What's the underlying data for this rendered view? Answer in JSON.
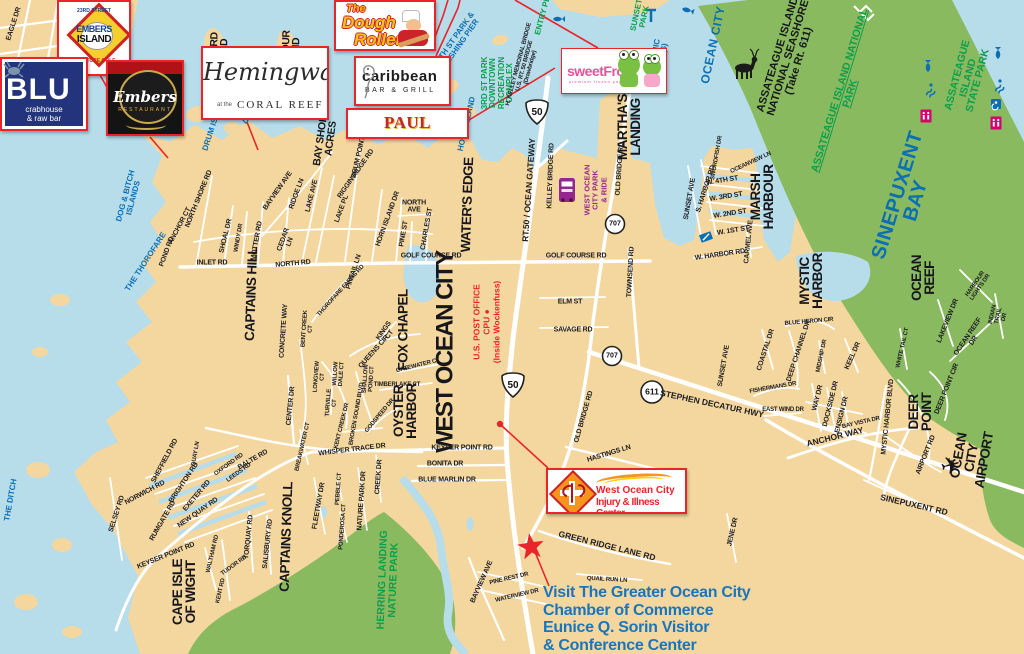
{
  "colors": {
    "water": "#b7dcea",
    "land": "#f4d79f",
    "green": "#8aba60",
    "label_blue": "#0b6fb4",
    "park_green": "#0d9e4c",
    "red": "#e8252a",
    "purple": "#93278f",
    "chamber_blue": "#1b75bc"
  },
  "ads": {
    "embers_island": {
      "l1": "23RD STREET",
      "l2": "EMBERS",
      "l3": "ISLAND",
      "l4": "MINIATURE GOLF"
    },
    "blu": {
      "name": "BLU",
      "sub1": "crabhouse",
      "sub2": "& raw bar"
    },
    "embers": {
      "name": "Embers",
      "sub": "RESTAURANT"
    },
    "hemingways": {
      "script": "Hemingway's",
      "at": "at the",
      "sub": "CORAL REEF"
    },
    "dough_roller": {
      "l1": "The",
      "l2": "Dough",
      "l3": "Roller"
    },
    "caribbean": {
      "name": "caribbean",
      "sub": "BAR & GRILL"
    },
    "paul_revere": {
      "name": "PAUL REVERE"
    },
    "sweetfrog": {
      "name": "sweetFrog",
      "sub": "premium frozen yogurt"
    },
    "injury_center": {
      "l1": "West Ocean City",
      "l2": "Injury & Illness Center"
    }
  },
  "chamber": {
    "l1": "Visit The Greater Ocean City",
    "l2": "Chamber of Commerce",
    "l3": "Eunice Q. Sorin Visitor",
    "l4": "& Conference Center"
  },
  "map_labels": [
    {
      "t": "DOG & BITCH\nISLANDS",
      "x": 130,
      "y": 197,
      "r": -75,
      "c": "water"
    },
    {
      "t": "THE THOROFARE",
      "x": 146,
      "y": 262,
      "r": -57,
      "c": "water"
    },
    {
      "t": "THE DITCH",
      "x": 11,
      "y": 500,
      "r": -80,
      "c": "water"
    },
    {
      "t": "DRUM ISLAND",
      "x": 214,
      "y": 124,
      "r": -72,
      "c": "water"
    },
    {
      "t": "DRUM POINT",
      "x": 263,
      "y": 106,
      "r": -42,
      "c": "water"
    },
    {
      "t": "HORN ISLAND",
      "x": 467,
      "y": 124,
      "r": -77,
      "c": "water"
    },
    {
      "t": "4TH ST PARK &\nFISHING PIER",
      "x": 459,
      "y": 40,
      "r": -55,
      "c": "water"
    },
    {
      "t": "OCEANIC\nPIER ($)",
      "x": 659,
      "y": 58,
      "r": -80,
      "c": "water"
    },
    {
      "t": "OCEAN CITY",
      "x": 713,
      "y": 45,
      "r": -78,
      "c": "water-lg"
    },
    {
      "t": "SINEPUXENT\nBAY",
      "x": 907,
      "y": 198,
      "r": -73,
      "c": "water-xl"
    },
    {
      "t": "3RD ST PARK\nDOWNTOWN\nRECREATION\nCOMPLEX",
      "x": 498,
      "y": 83,
      "r": -90,
      "c": "park"
    },
    {
      "t": "ENTRY PL",
      "x": 543,
      "y": 16,
      "r": -75,
      "c": "park"
    },
    {
      "t": "SUNSET\nPARK",
      "x": 641,
      "y": 16,
      "r": -78,
      "c": "park"
    },
    {
      "t": "ASSATEAGUE ISLAND NATIONAL PARK",
      "x": 845,
      "y": 92,
      "r": -73,
      "c": "park-lg u"
    },
    {
      "t": "ASSATEAGUE ISLAND\nSTATE PARK",
      "x": 968,
      "y": 78,
      "r": -75,
      "c": "park-lg"
    },
    {
      "t": "HERRING LANDING\nNATURE PARK",
      "x": 388,
      "y": 580,
      "r": -88,
      "c": "park-lg"
    },
    {
      "t": "ASSATEAGUE ISLAND\nNATIONAL SEASHORE\n(Take Rt. 611)",
      "x": 789,
      "y": 58,
      "r": -73,
      "c": "seashore"
    },
    {
      "t": "WEST OCEAN\nCITY PARK\n& RIDE",
      "x": 596,
      "y": 190,
      "r": -90,
      "c": "purple"
    },
    {
      "t": "U.S. POST OFFICE\nCPU ●\n(Inside Wockenfuss)",
      "x": 487,
      "y": 322,
      "r": -90,
      "c": "redlbl"
    },
    {
      "t": "MALLARD\nISLAND",
      "x": 219,
      "y": 57,
      "r": -88,
      "c": "area"
    },
    {
      "t": "HARBOUR\nISLAND",
      "x": 291,
      "y": 56,
      "r": -88,
      "c": "area"
    },
    {
      "t": "BAY SHORE\nACRES",
      "x": 326,
      "y": 138,
      "r": -82,
      "c": "area"
    },
    {
      "t": "WATER'S EDGE",
      "x": 468,
      "y": 205,
      "r": -88,
      "c": "area-lg"
    },
    {
      "t": "MARTHA'S\nLANDING",
      "x": 630,
      "y": 127,
      "r": -90,
      "c": "area-lg"
    },
    {
      "t": "MARSH\nHARBOUR",
      "x": 763,
      "y": 197,
      "r": -90,
      "c": "area-lg"
    },
    {
      "t": "MYSTIC\nHARBOR",
      "x": 812,
      "y": 281,
      "r": -90,
      "c": "area-lg"
    },
    {
      "t": "OCEAN\nREEF",
      "x": 924,
      "y": 278,
      "r": -90,
      "c": "area-lg"
    },
    {
      "t": "DEER\nPOINT",
      "x": 921,
      "y": 412,
      "r": -90,
      "c": "area-lg"
    },
    {
      "t": "CAPE ISLE\nOF WIGHT",
      "x": 185,
      "y": 592,
      "r": -90,
      "c": "area-lg"
    },
    {
      "t": "CAPTAINS KNOLL",
      "x": 287,
      "y": 537,
      "r": -88,
      "c": "area-lg"
    },
    {
      "t": "CAPTAINS HILL",
      "x": 252,
      "y": 294,
      "r": -88,
      "c": "area-lg"
    },
    {
      "t": "WEST OCEAN CITY",
      "x": 446,
      "y": 352,
      "r": -90,
      "c": "area-xl"
    },
    {
      "t": "FOX CHAPEL",
      "x": 404,
      "y": 330,
      "r": -90,
      "c": "area-lg"
    },
    {
      "t": "OYSTER\nHARBOR",
      "x": 406,
      "y": 411,
      "r": -90,
      "c": "area-lg"
    },
    {
      "t": "OCEAN CITY AIRPORT",
      "x": 972,
      "y": 458,
      "r": -80,
      "c": "area-lg"
    },
    {
      "t": "✈",
      "x": 951,
      "y": 467,
      "r": -15,
      "c": "plane"
    },
    {
      "t": "EAGLE DR",
      "x": 14,
      "y": 24,
      "r": -72,
      "c": "road"
    },
    {
      "t": "DRUM POINT RD",
      "x": 360,
      "y": 152,
      "r": -77,
      "c": "road"
    },
    {
      "t": "NORTH SHORE RD",
      "x": 199,
      "y": 199,
      "r": -68,
      "c": "road"
    },
    {
      "t": "ANCHOR CT",
      "x": 180,
      "y": 226,
      "r": -62,
      "c": "road"
    },
    {
      "t": "POND RD",
      "x": 167,
      "y": 252,
      "r": -70,
      "c": "road"
    },
    {
      "t": "SHOAL DR",
      "x": 226,
      "y": 236,
      "r": -76,
      "c": "road"
    },
    {
      "t": "WINDY DR",
      "x": 239,
      "y": 238,
      "r": -80,
      "c": "road-sm"
    },
    {
      "t": "MOTTER RD",
      "x": 257,
      "y": 241,
      "r": -80,
      "c": "road"
    },
    {
      "t": "CEDAR\nLN",
      "x": 287,
      "y": 241,
      "r": -70,
      "c": "road"
    },
    {
      "t": "INLET RD",
      "x": 212,
      "y": 263,
      "r": 0,
      "c": "road"
    },
    {
      "t": "NORTH RD",
      "x": 293,
      "y": 264,
      "r": -5,
      "c": "road"
    },
    {
      "t": "BAYVIEW AVE",
      "x": 278,
      "y": 191,
      "r": -55,
      "c": "road"
    },
    {
      "t": "RIDGE LN",
      "x": 297,
      "y": 194,
      "r": -70,
      "c": "road"
    },
    {
      "t": "LAKE AVE",
      "x": 312,
      "y": 196,
      "r": -76,
      "c": "road"
    },
    {
      "t": "LAKE PL",
      "x": 342,
      "y": 209,
      "r": -70,
      "c": "road"
    },
    {
      "t": "RIGGIN RIDGE RD",
      "x": 356,
      "y": 174,
      "r": -55,
      "c": "road"
    },
    {
      "t": "HORN ISLAND DR",
      "x": 388,
      "y": 219,
      "r": -70,
      "c": "road"
    },
    {
      "t": "PINE ST",
      "x": 404,
      "y": 234,
      "r": -80,
      "c": "road"
    },
    {
      "t": "NORTH\nAVE",
      "x": 414,
      "y": 207,
      "r": 0,
      "c": "road"
    },
    {
      "t": "CHARLES ST",
      "x": 427,
      "y": 229,
      "r": -80,
      "c": "road"
    },
    {
      "t": "GOLF COURSE RD",
      "x": 431,
      "y": 256,
      "r": 0,
      "c": "road"
    },
    {
      "t": "GOLF COURSE RD",
      "x": 576,
      "y": 256,
      "r": 0,
      "c": "road"
    },
    {
      "t": "PINTAIL LN",
      "x": 354,
      "y": 272,
      "r": -72,
      "c": "road"
    },
    {
      "t": "THOROFARE FARMS RD",
      "x": 341,
      "y": 291,
      "r": -48,
      "c": "road-sm"
    },
    {
      "t": "CONCRETE WAY",
      "x": 284,
      "y": 331,
      "r": -86,
      "c": "road"
    },
    {
      "t": "BENT CREEK\nCT",
      "x": 308,
      "y": 329,
      "r": -86,
      "c": "road-sm"
    },
    {
      "t": "KINGS\nCT",
      "x": 387,
      "y": 333,
      "r": -55,
      "c": "road"
    },
    {
      "t": "QUEENS CIR",
      "x": 374,
      "y": 352,
      "r": -48,
      "c": "road"
    },
    {
      "t": "GATEWATER CT",
      "x": 418,
      "y": 366,
      "r": -14,
      "c": "road-sm"
    },
    {
      "t": "TIMBERLAKE CT",
      "x": 397,
      "y": 385,
      "r": 0,
      "c": "road-sm"
    },
    {
      "t": "LONGVIEW\nCT",
      "x": 320,
      "y": 377,
      "r": -86,
      "c": "road-sm"
    },
    {
      "t": "WILLOW\nDALE CT",
      "x": 339,
      "y": 374,
      "r": -86,
      "c": "road-sm"
    },
    {
      "t": "SHALLOW\nPOND CT",
      "x": 369,
      "y": 379,
      "r": -86,
      "c": "road-sm"
    },
    {
      "t": "TURVILLE\nCT",
      "x": 332,
      "y": 403,
      "r": -86,
      "c": "road-sm"
    },
    {
      "t": "BROKEN SOUND BLVD",
      "x": 357,
      "y": 414,
      "r": -80,
      "c": "road-sm"
    },
    {
      "t": "GODSPEED DR",
      "x": 380,
      "y": 416,
      "r": -50,
      "c": "road-sm"
    },
    {
      "t": "KENT CREEK DR",
      "x": 342,
      "y": 426,
      "r": -76,
      "c": "road-sm"
    },
    {
      "t": "CENTER DR",
      "x": 291,
      "y": 406,
      "r": -84,
      "c": "road"
    },
    {
      "t": "ELM ST",
      "x": 570,
      "y": 302,
      "r": 0,
      "c": "road"
    },
    {
      "t": "SAVAGE RD",
      "x": 573,
      "y": 330,
      "r": 0,
      "c": "road"
    },
    {
      "t": "RT.50 / OCEAN GATEWAY",
      "x": 529,
      "y": 190,
      "r": -86,
      "c": "road-lg"
    },
    {
      "t": "KELLEY BRIDGE RD",
      "x": 551,
      "y": 176,
      "r": -88,
      "c": "road"
    },
    {
      "t": "H. KELLEY MEMORIAL BRIDGE\nU.S. RT. 50 BRIDGE\n(Drawbridge)",
      "x": 525,
      "y": 66,
      "r": -75,
      "c": "road-sm"
    },
    {
      "t": "OLD BRIDGE RD",
      "x": 620,
      "y": 169,
      "r": -86,
      "c": "road"
    },
    {
      "t": "OLD BRIDGE RD",
      "x": 584,
      "y": 417,
      "r": -74,
      "c": "road"
    },
    {
      "t": "TOWNSEND RD",
      "x": 631,
      "y": 272,
      "r": -87,
      "c": "road"
    },
    {
      "t": "SUNSET AVE",
      "x": 690,
      "y": 199,
      "r": -80,
      "c": "road"
    },
    {
      "t": "S. HARBOR RD",
      "x": 706,
      "y": 189,
      "r": -72,
      "c": "road"
    },
    {
      "t": "SWORDFISH DR",
      "x": 717,
      "y": 158,
      "r": -80,
      "c": "road-sm"
    },
    {
      "t": "OCEANVIEW LN",
      "x": 751,
      "y": 163,
      "r": -25,
      "c": "road-sm"
    },
    {
      "t": "W. 4TH ST",
      "x": 722,
      "y": 181,
      "r": -9,
      "c": "road"
    },
    {
      "t": "W. 3RD ST",
      "x": 726,
      "y": 197,
      "r": -9,
      "c": "road"
    },
    {
      "t": "W. 2ND ST",
      "x": 730,
      "y": 214,
      "r": -9,
      "c": "road"
    },
    {
      "t": "W. 1ST ST",
      "x": 733,
      "y": 231,
      "r": -9,
      "c": "road"
    },
    {
      "t": "W. HARBOR RD",
      "x": 720,
      "y": 255,
      "r": -8,
      "c": "road"
    },
    {
      "t": "CARMEL AVE",
      "x": 749,
      "y": 242,
      "r": -84,
      "c": "road"
    },
    {
      "t": "HASTINGS LN",
      "x": 609,
      "y": 454,
      "r": -17,
      "c": "road"
    },
    {
      "t": "STEPHEN DECATUR HWY",
      "x": 712,
      "y": 404,
      "r": 12,
      "c": "road-lg"
    },
    {
      "t": "SUNSET AVE",
      "x": 724,
      "y": 366,
      "r": -80,
      "c": "road"
    },
    {
      "t": "FISHERMANS DR",
      "x": 773,
      "y": 388,
      "r": -10,
      "c": "road-sm"
    },
    {
      "t": "EAST WIND DR",
      "x": 783,
      "y": 410,
      "r": 0,
      "c": "road-sm"
    },
    {
      "t": "COASTAL DR",
      "x": 766,
      "y": 350,
      "r": -72,
      "c": "road"
    },
    {
      "t": "DEEP CHANNEL DR",
      "x": 799,
      "y": 351,
      "r": -72,
      "c": "road"
    },
    {
      "t": "MIDSHIP DR",
      "x": 822,
      "y": 356,
      "r": -78,
      "c": "road-sm"
    },
    {
      "t": "KEEL DR",
      "x": 853,
      "y": 356,
      "r": -66,
      "c": "road"
    },
    {
      "t": "WAY DR",
      "x": 818,
      "y": 398,
      "r": -76,
      "c": "road"
    },
    {
      "t": "DOCKSIDE DR",
      "x": 831,
      "y": 404,
      "r": -76,
      "c": "road"
    },
    {
      "t": "ENSIGN DR",
      "x": 842,
      "y": 415,
      "r": -76,
      "c": "road"
    },
    {
      "t": "BAY VISTA DR",
      "x": 861,
      "y": 423,
      "r": -13,
      "c": "road-sm"
    },
    {
      "t": "ANCHOR WAY",
      "x": 835,
      "y": 437,
      "r": -14,
      "c": "road-lg"
    },
    {
      "t": "MYSTIC HARBOR BLVD",
      "x": 888,
      "y": 417,
      "r": -84,
      "c": "road"
    },
    {
      "t": "BLUE HERON CIR",
      "x": 809,
      "y": 322,
      "r": -5,
      "c": "road-sm"
    },
    {
      "t": "WHITE TAIL CT",
      "x": 903,
      "y": 348,
      "r": -77,
      "c": "road-sm"
    },
    {
      "t": "DEER POINT CIR",
      "x": 947,
      "y": 389,
      "r": -68,
      "c": "road"
    },
    {
      "t": "LAKEVIEW DR",
      "x": 948,
      "y": 321,
      "r": -68,
      "c": "road"
    },
    {
      "t": "OCEAN REEF DR",
      "x": 971,
      "y": 339,
      "r": -56,
      "c": "road"
    },
    {
      "t": "HARBOUR LIGHTS DR",
      "x": 978,
      "y": 286,
      "r": -55,
      "c": "road-sm"
    },
    {
      "t": "INDIAN TRAIL DR",
      "x": 999,
      "y": 316,
      "r": -77,
      "c": "road-sm"
    },
    {
      "t": "AIRPORT RD",
      "x": 926,
      "y": 455,
      "r": -68,
      "c": "road"
    },
    {
      "t": "SINEPUXENT RD",
      "x": 914,
      "y": 505,
      "r": 13,
      "c": "road-lg"
    },
    {
      "t": "JENE DR",
      "x": 733,
      "y": 532,
      "r": -77,
      "c": "road"
    },
    {
      "t": "GREEN RIDGE LANE RD",
      "x": 607,
      "y": 546,
      "r": 14,
      "c": "road-lg"
    },
    {
      "t": "QUAIL RUN LN",
      "x": 607,
      "y": 580,
      "r": 3,
      "c": "road-sm"
    },
    {
      "t": "KEYSER POINT RD",
      "x": 462,
      "y": 448,
      "r": 0,
      "c": "road"
    },
    {
      "t": "BONITA DR",
      "x": 445,
      "y": 464,
      "r": 0,
      "c": "road"
    },
    {
      "t": "BLUE MARLIN DR",
      "x": 447,
      "y": 480,
      "r": 0,
      "c": "road"
    },
    {
      "t": "WHISPER TRACE DR",
      "x": 352,
      "y": 450,
      "r": -7,
      "c": "road"
    },
    {
      "t": "CREEK DR",
      "x": 379,
      "y": 477,
      "r": -86,
      "c": "road"
    },
    {
      "t": "NATURE PARK DR",
      "x": 362,
      "y": 501,
      "r": -86,
      "c": "road"
    },
    {
      "t": "PEBBLE CT",
      "x": 339,
      "y": 489,
      "r": -86,
      "c": "road-sm"
    },
    {
      "t": "PONDEROSA CT",
      "x": 343,
      "y": 527,
      "r": -86,
      "c": "road-sm"
    },
    {
      "t": "FLEETWAY DR",
      "x": 319,
      "y": 506,
      "r": -80,
      "c": "road"
    },
    {
      "t": "BREAKWATER CT",
      "x": 303,
      "y": 447,
      "r": -77,
      "c": "road-sm"
    },
    {
      "t": "SELSEY RD",
      "x": 117,
      "y": 514,
      "r": -72,
      "c": "road"
    },
    {
      "t": "NORWICH RD",
      "x": 145,
      "y": 493,
      "r": -28,
      "c": "road"
    },
    {
      "t": "SHEFFIELD RD",
      "x": 165,
      "y": 461,
      "r": -62,
      "c": "road"
    },
    {
      "t": "BRIGHTON RD",
      "x": 184,
      "y": 483,
      "r": -56,
      "c": "road"
    },
    {
      "t": "EXETER RD",
      "x": 197,
      "y": 496,
      "r": -50,
      "c": "road"
    },
    {
      "t": "NEW QUAY RD",
      "x": 198,
      "y": 513,
      "r": -35,
      "c": "road"
    },
    {
      "t": "QUAY LN",
      "x": 196,
      "y": 454,
      "r": -80,
      "c": "road-sm"
    },
    {
      "t": "OXFORD RD",
      "x": 229,
      "y": 465,
      "r": -36,
      "c": "road-sm"
    },
    {
      "t": "LEEDS RD",
      "x": 239,
      "y": 473,
      "r": -36,
      "c": "road-sm"
    },
    {
      "t": "BALTE RD",
      "x": 253,
      "y": 460,
      "r": -30,
      "c": "road"
    },
    {
      "t": "RUMGATE RD",
      "x": 163,
      "y": 521,
      "r": -60,
      "c": "road"
    },
    {
      "t": "KEYSER POINT RD",
      "x": 166,
      "y": 556,
      "r": -22,
      "c": "road"
    },
    {
      "t": "WALTHAM RD",
      "x": 213,
      "y": 554,
      "r": -77,
      "c": "road-sm"
    },
    {
      "t": "TUDOR RD",
      "x": 234,
      "y": 566,
      "r": -36,
      "c": "road-sm"
    },
    {
      "t": "KENT RD",
      "x": 221,
      "y": 591,
      "r": -77,
      "c": "road-sm"
    },
    {
      "t": "TORQUAY RD",
      "x": 249,
      "y": 537,
      "r": -84,
      "c": "road"
    },
    {
      "t": "SALISBURY RD",
      "x": 268,
      "y": 544,
      "r": -84,
      "c": "road"
    },
    {
      "t": "BAYVIEW AVE",
      "x": 482,
      "y": 582,
      "r": -66,
      "c": "road"
    },
    {
      "t": "PINE REST DR",
      "x": 509,
      "y": 579,
      "r": -13,
      "c": "road-sm"
    },
    {
      "t": "WATERVIEW DR",
      "x": 517,
      "y": 596,
      "r": -13,
      "c": "road-sm"
    },
    {
      "t": "50",
      "x": 537,
      "y": 113,
      "r": 0,
      "c": "shield"
    },
    {
      "t": "50",
      "x": 513,
      "y": 386,
      "r": 0,
      "c": "shield"
    },
    {
      "t": "707",
      "x": 615,
      "y": 224,
      "r": 0,
      "c": "shield7"
    },
    {
      "t": "707",
      "x": 612,
      "y": 356,
      "r": 0,
      "c": "shield7"
    },
    {
      "t": "611",
      "x": 652,
      "y": 392,
      "r": 0,
      "c": "shield6"
    }
  ]
}
